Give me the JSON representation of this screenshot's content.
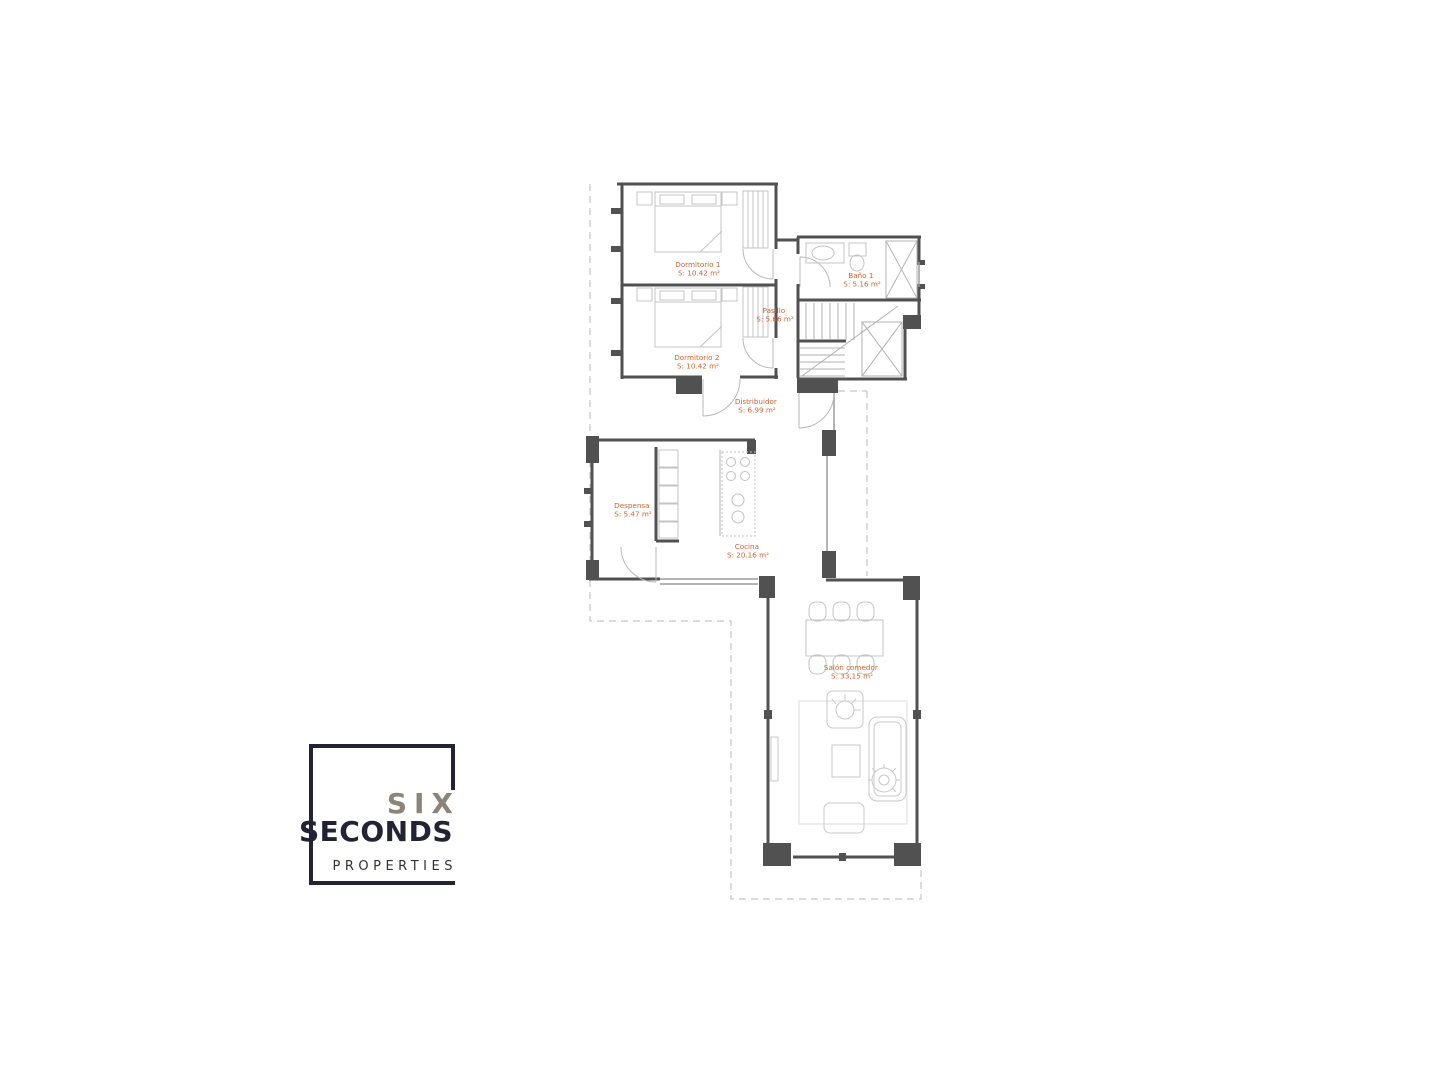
{
  "plan": {
    "rooms": [
      {
        "name": "Dormitorio 1",
        "area": "S: 10.42 m²"
      },
      {
        "name": "Dormitorio 2",
        "area": "S: 10.42 m²"
      },
      {
        "name": "Baño 1",
        "area": "S: 5.16 m²"
      },
      {
        "name": "Pasillo",
        "area": "S: 5.66 m²"
      },
      {
        "name": "Distribuidor",
        "area": "S: 6.99 m²"
      },
      {
        "name": "Despensa",
        "area": "S: 5.47 m²"
      },
      {
        "name": "Cocina",
        "area": "S: 20.16 m²"
      },
      {
        "name": "Salón comedor",
        "area": "S: 33,15 m²"
      }
    ],
    "colors": {
      "wall": "#515151",
      "furniture": "#c4c4c4",
      "label": "#cc6633",
      "dashed_boundary": "#c6c6c6"
    }
  },
  "logo": {
    "line1": "SIX",
    "line2": "SECONDS",
    "line3": "PROPERTIES",
    "colors": {
      "six": "#8d8478",
      "seconds": "#232334",
      "properties": "#30303c",
      "frame": "#232334"
    }
  }
}
